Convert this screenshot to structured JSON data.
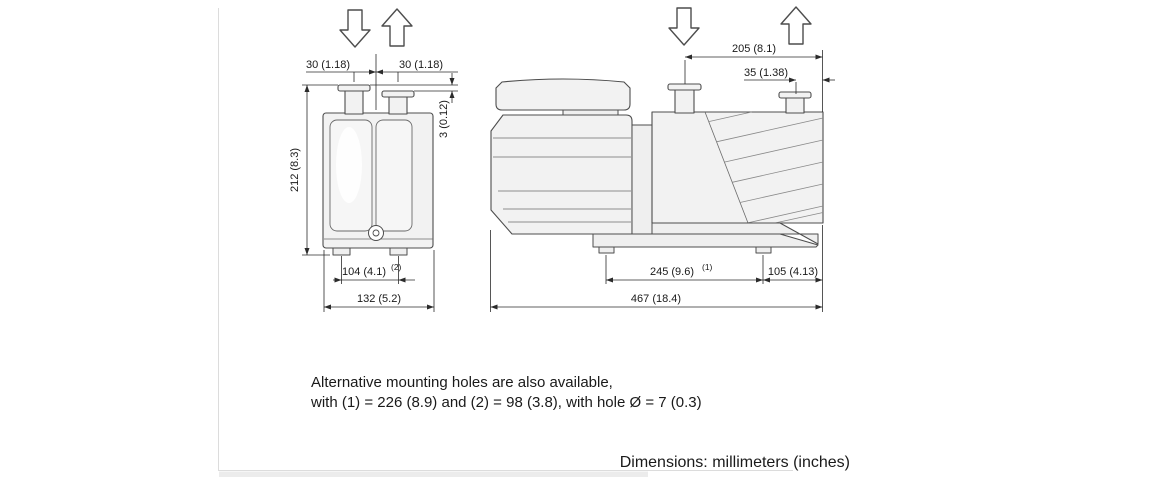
{
  "colors": {
    "line": "#4d4d4d",
    "dimension": "#2b2b2b",
    "body_fill": "#f2f2f2",
    "page_edge": "#dcdcdc"
  },
  "front_view": {
    "dim_inlet_offset_left": "30 (1.18)",
    "dim_inlet_offset_right": "30 (1.18)",
    "dim_height": "212 (8.3)",
    "dim_port_height_diff": "3 (0.12)",
    "dim_foot_spacing": "104 (4.1)",
    "dim_foot_spacing_sup": "(2)",
    "dim_width": "132 (5.2)"
  },
  "side_view": {
    "dim_port_span": "205 (8.1)",
    "dim_exhaust_offset": "35 (1.38)",
    "dim_foot_spacing": "245 (9.6)",
    "dim_foot_spacing_sup": "(1)",
    "dim_foot_to_end": "105 (4.13)",
    "dim_length": "467 (18.4)"
  },
  "note": {
    "line1": "Alternative mounting holes are also available,",
    "line2": "with (1) = 226 (8.9) and (2) = 98 (3.8), with hole Ø = 7 (0.3)"
  },
  "footer": {
    "text": "Dimensions: millimeters (inches)"
  }
}
